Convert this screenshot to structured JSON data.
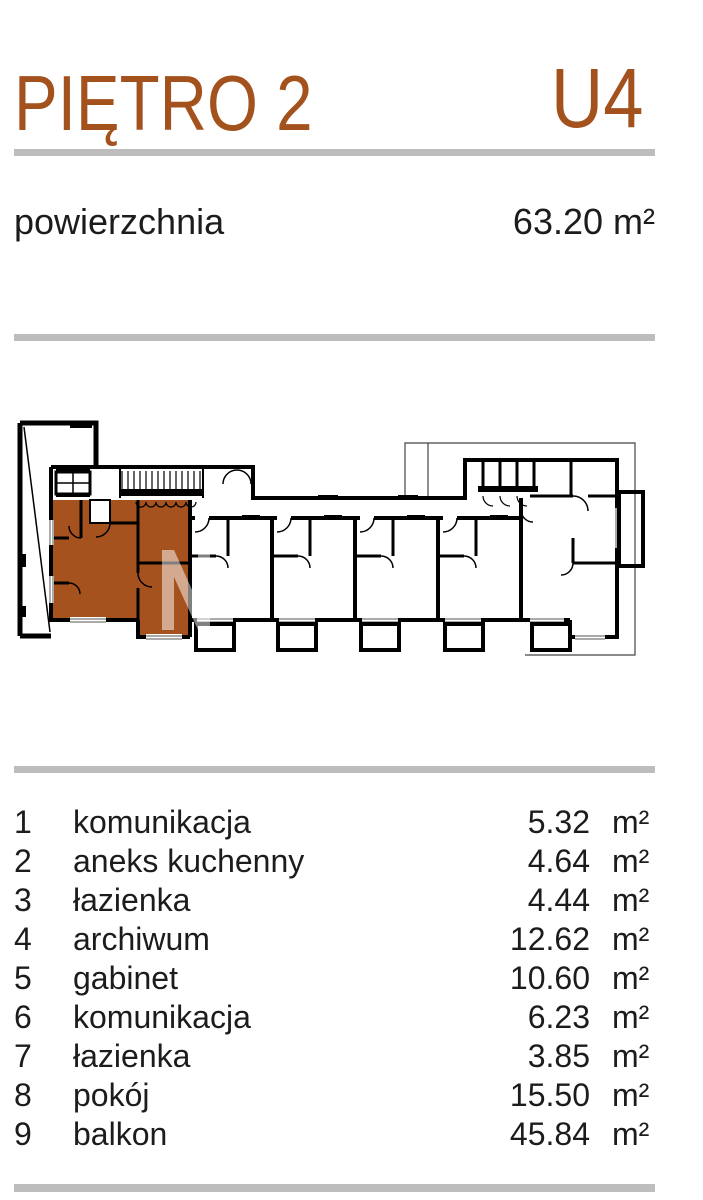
{
  "header": {
    "floor_label": "PIĘTRO 2",
    "unit_label": "U4"
  },
  "area_summary": {
    "label": "powierzchnia",
    "value": "63.20 m²"
  },
  "rooms": [
    {
      "no": "1",
      "name": "komunikacja",
      "area": "5.32",
      "unit": "m²"
    },
    {
      "no": "2",
      "name": "aneks kuchenny",
      "area": "4.64",
      "unit": "m²"
    },
    {
      "no": "3",
      "name": "łazienka",
      "area": "4.44",
      "unit": "m²"
    },
    {
      "no": "4",
      "name": "archiwum",
      "area": "12.62",
      "unit": "m²"
    },
    {
      "no": "5",
      "name": "gabinet",
      "area": "10.60",
      "unit": "m²"
    },
    {
      "no": "6",
      "name": "komunikacja",
      "area": "6.23",
      "unit": "m²"
    },
    {
      "no": "7",
      "name": "łazienka",
      "area": "3.85",
      "unit": "m²"
    },
    {
      "no": "8",
      "name": "pokój",
      "area": "15.50",
      "unit": "m²"
    },
    {
      "no": "9",
      "name": "balkon",
      "area": "45.84",
      "unit": "m²"
    }
  ],
  "plan": {
    "watermark_letter": "N",
    "highlight_color": "#a6521e"
  },
  "colors": {
    "accent": "#a3511d",
    "divider": "#bdbdbd",
    "text": "#1c1c1c"
  }
}
